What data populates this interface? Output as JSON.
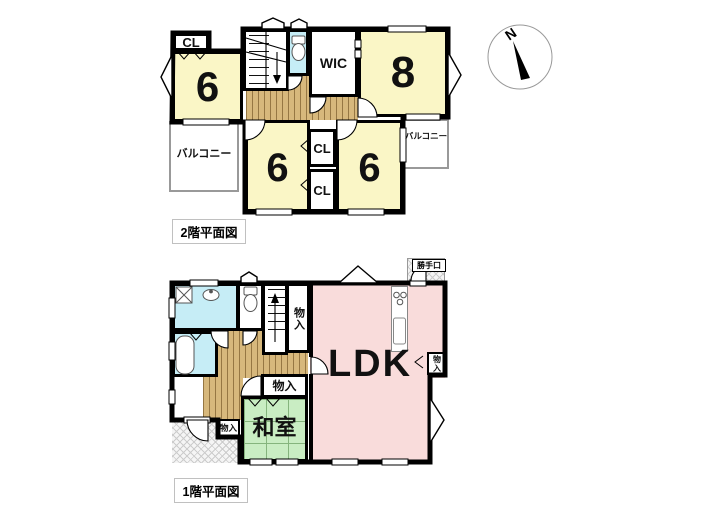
{
  "compass": {
    "north": "N"
  },
  "floor2": {
    "title": "2階平面図",
    "labels": {
      "cl_top": "CL",
      "room6_a": "6",
      "room8": "8",
      "wic": "WIC",
      "balcony_left": "バルコニー",
      "room6_b": "6",
      "cl_mid": "CL",
      "cl_bottom": "CL",
      "room6_c": "6",
      "balcony_right": "バルコニー"
    }
  },
  "floor1": {
    "title": "1階平面図",
    "labels": {
      "katteguchi": "勝手口",
      "monoire_stair": "物入",
      "ldk": "LDK",
      "monoire_ldk": "物入",
      "monoire_hall": "物入",
      "washitsu": "和室",
      "monoire_entry": "物入"
    }
  },
  "colors": {
    "wall": "#000000",
    "room_yellow": "#faf6c6",
    "wet_area_blue": "#c6edf6",
    "ldk_pink": "#f9dcdb",
    "tatami_green": "#c9edc3",
    "wood_floor": "#d7b87c",
    "balcony_outline": "#999999"
  }
}
